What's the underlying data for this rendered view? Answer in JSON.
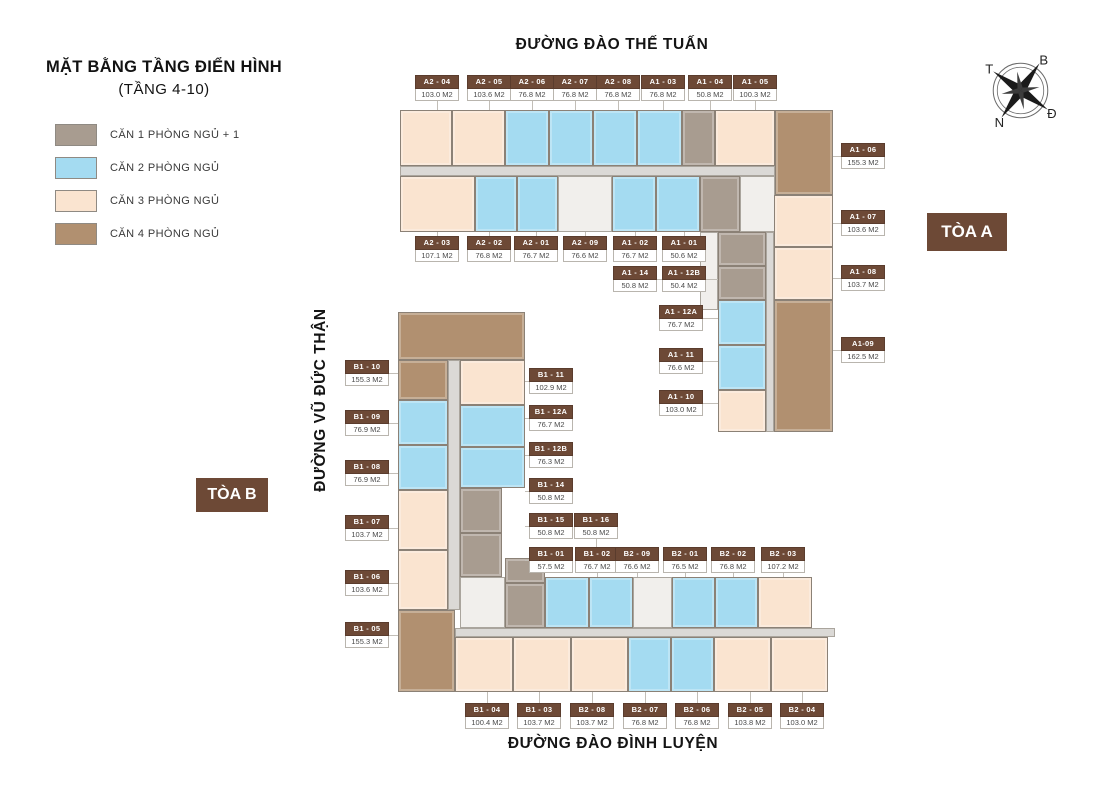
{
  "title": {
    "line1": "MẶT BẰNG TẦNG ĐIỂN HÌNH",
    "line2": "(TẦNG 4-10)"
  },
  "legend": [
    {
      "label": "CĂN 1 PHÒNG NGỦ + 1",
      "color": "#a89c90"
    },
    {
      "label": "CĂN 2 PHÒNG NGỦ",
      "color": "#a4dbf1"
    },
    {
      "label": "CĂN 3 PHÒNG NGỦ",
      "color": "#fae4d0"
    },
    {
      "label": "CĂN 4 PHÒNG NGỦ",
      "color": "#b19070"
    }
  ],
  "streets": {
    "top": "ĐƯỜNG ĐÀO THẾ TUẤN",
    "left": "ĐƯỜNG VŨ ĐỨC THẬN",
    "bottom": "ĐƯỜNG ĐÀO ĐÌNH LUYỆN"
  },
  "towers": {
    "a": "TÒA A",
    "b": "TÒA B"
  },
  "compass": {
    "north": "B",
    "east": "Đ",
    "south": "N",
    "west": "T"
  },
  "colors": {
    "t1": "#a89c90",
    "t2": "#a4dbf1",
    "t3": "#fae4d0",
    "t4": "#b19070",
    "core": "#f1efec",
    "corr": "#dbd9d6",
    "label_bg": "#6d4936",
    "tag_bg": "#6d4936"
  },
  "unit_labels": [
    {
      "code": "A2 - 04",
      "area": "103.0 M2",
      "x": 415,
      "y": 75,
      "dir": "d",
      "len": 9
    },
    {
      "code": "A2 - 05",
      "area": "103.6 M2",
      "x": 467,
      "y": 75,
      "dir": "d",
      "len": 9
    },
    {
      "code": "A2 - 06",
      "area": "76.8 M2",
      "x": 510,
      "y": 75,
      "dir": "d",
      "len": 9
    },
    {
      "code": "A2 - 07",
      "area": "76.8 M2",
      "x": 553,
      "y": 75,
      "dir": "d",
      "len": 9
    },
    {
      "code": "A2 - 08",
      "area": "76.8 M2",
      "x": 596,
      "y": 75,
      "dir": "d",
      "len": 9
    },
    {
      "code": "A1 - 03",
      "area": "76.8 M2",
      "x": 641,
      "y": 75,
      "dir": "d",
      "len": 9
    },
    {
      "code": "A1 - 04",
      "area": "50.8 M2",
      "x": 688,
      "y": 75,
      "dir": "d",
      "len": 9
    },
    {
      "code": "A1 - 05",
      "area": "100.3 M2",
      "x": 733,
      "y": 75,
      "dir": "d",
      "len": 9
    },
    {
      "code": "A2 - 03",
      "area": "107.1 M2",
      "x": 415,
      "y": 236,
      "dir": "u",
      "len": 4
    },
    {
      "code": "A2 - 02",
      "area": "76.8 M2",
      "x": 467,
      "y": 236,
      "dir": "u",
      "len": 4
    },
    {
      "code": "A2 - 01",
      "area": "76.7 M2",
      "x": 514,
      "y": 236,
      "dir": "u",
      "len": 4
    },
    {
      "code": "A2 - 09",
      "area": "76.6 M2",
      "x": 563,
      "y": 236,
      "dir": "u",
      "len": 4
    },
    {
      "code": "A1 - 02",
      "area": "76.7 M2",
      "x": 613,
      "y": 236,
      "dir": "u",
      "len": 4
    },
    {
      "code": "A1 - 01",
      "area": "50.6 M2",
      "x": 662,
      "y": 236,
      "dir": "u",
      "len": 4
    },
    {
      "code": "A1 - 14",
      "area": "50.8 M2",
      "x": 613,
      "y": 266,
      "dir": "r",
      "len": 61
    },
    {
      "code": "A1 - 12B",
      "area": "50.4 M2",
      "x": 662,
      "y": 266,
      "dir": "r",
      "len": 12
    },
    {
      "code": "A1 - 12A",
      "area": "76.7 M2",
      "x": 659,
      "y": 305,
      "dir": "r",
      "len": 15
    },
    {
      "code": "A1 - 11",
      "area": "76.6 M2",
      "x": 659,
      "y": 348,
      "dir": "r",
      "len": 15
    },
    {
      "code": "A1 - 10",
      "area": "103.0 M2",
      "x": 659,
      "y": 390,
      "dir": "r",
      "len": 15
    },
    {
      "code": "A1 - 06",
      "area": "155.3 M2",
      "x": 841,
      "y": 143,
      "dir": "l",
      "len": 8
    },
    {
      "code": "A1 - 07",
      "area": "103.6 M2",
      "x": 841,
      "y": 210,
      "dir": "l",
      "len": 8
    },
    {
      "code": "A1 - 08",
      "area": "103.7 M2",
      "x": 841,
      "y": 265,
      "dir": "l",
      "len": 8
    },
    {
      "code": "A1-09",
      "area": "162.5 M2",
      "x": 841,
      "y": 337,
      "dir": "l",
      "len": 8
    },
    {
      "code": "B1 - 10",
      "area": "155.3 M2",
      "x": 345,
      "y": 360,
      "dir": "r",
      "len": 9
    },
    {
      "code": "B1 - 09",
      "area": "76.9 M2",
      "x": 345,
      "y": 410,
      "dir": "r",
      "len": 9
    },
    {
      "code": "B1 - 08",
      "area": "76.9 M2",
      "x": 345,
      "y": 460,
      "dir": "r",
      "len": 9
    },
    {
      "code": "B1 - 07",
      "area": "103.7 M2",
      "x": 345,
      "y": 515,
      "dir": "r",
      "len": 9
    },
    {
      "code": "B1 - 06",
      "area": "103.6 M2",
      "x": 345,
      "y": 570,
      "dir": "r",
      "len": 9
    },
    {
      "code": "B1 - 05",
      "area": "155.3 M2",
      "x": 345,
      "y": 622,
      "dir": "r",
      "len": 9
    },
    {
      "code": "B1 - 11",
      "area": "102.9 M2",
      "x": 529,
      "y": 368,
      "dir": "l",
      "len": 4
    },
    {
      "code": "B1 - 12A",
      "area": "76.7 M2",
      "x": 529,
      "y": 405,
      "dir": "l",
      "len": 4
    },
    {
      "code": "B1 - 12B",
      "area": "76.3 M2",
      "x": 529,
      "y": 442,
      "dir": "l",
      "len": 4
    },
    {
      "code": "B1 - 14",
      "area": "50.8 M2",
      "x": 529,
      "y": 478,
      "dir": "l",
      "len": 4
    },
    {
      "code": "B1 - 15",
      "area": "50.8 M2",
      "x": 529,
      "y": 513,
      "dir": "l",
      "len": 4
    },
    {
      "code": "B1 - 01",
      "area": "57.5 M2",
      "x": 529,
      "y": 547,
      "dir": "l",
      "len": 4
    },
    {
      "code": "B1 - 16",
      "area": "50.8 M2",
      "x": 574,
      "y": 513,
      "dir": "d",
      "len": 19
    },
    {
      "code": "B1 - 02",
      "area": "76.7 M2",
      "x": 575,
      "y": 547,
      "dir": "d",
      "len": 4
    },
    {
      "code": "B2 - 09",
      "area": "76.6 M2",
      "x": 615,
      "y": 547,
      "dir": "d",
      "len": 4
    },
    {
      "code": "B2 - 01",
      "area": "76.5 M2",
      "x": 663,
      "y": 547,
      "dir": "d",
      "len": 4
    },
    {
      "code": "B2 - 02",
      "area": "76.8 M2",
      "x": 711,
      "y": 547,
      "dir": "d",
      "len": 4
    },
    {
      "code": "B2 - 03",
      "area": "107.2 M2",
      "x": 761,
      "y": 547,
      "dir": "d",
      "len": 4
    },
    {
      "code": "B1 - 04",
      "area": "100.4 M2",
      "x": 465,
      "y": 703,
      "dir": "u",
      "len": 11
    },
    {
      "code": "B1 - 03",
      "area": "103.7 M2",
      "x": 517,
      "y": 703,
      "dir": "u",
      "len": 11
    },
    {
      "code": "B2 - 08",
      "area": "103.7 M2",
      "x": 570,
      "y": 703,
      "dir": "u",
      "len": 11
    },
    {
      "code": "B2 - 07",
      "area": "76.8 M2",
      "x": 623,
      "y": 703,
      "dir": "u",
      "len": 11
    },
    {
      "code": "B2 - 06",
      "area": "76.8 M2",
      "x": 675,
      "y": 703,
      "dir": "u",
      "len": 11
    },
    {
      "code": "B2 - 05",
      "area": "103.8 M2",
      "x": 728,
      "y": 703,
      "dir": "u",
      "len": 11
    },
    {
      "code": "B2 - 04",
      "area": "103.0 M2",
      "x": 780,
      "y": 703,
      "dir": "u",
      "len": 11
    }
  ],
  "plan_blocks": [
    {
      "n": "unit-a2-04",
      "t": "t3",
      "x": 400,
      "y": 110,
      "w": 52,
      "h": 56
    },
    {
      "n": "unit-a2-05",
      "t": "t3",
      "x": 452,
      "y": 110,
      "w": 53,
      "h": 56
    },
    {
      "n": "unit-a2-06",
      "t": "t2",
      "x": 505,
      "y": 110,
      "w": 44,
      "h": 56
    },
    {
      "n": "unit-a2-07",
      "t": "t2",
      "x": 549,
      "y": 110,
      "w": 44,
      "h": 56
    },
    {
      "n": "unit-a2-08",
      "t": "t2",
      "x": 593,
      "y": 110,
      "w": 44,
      "h": 56
    },
    {
      "n": "unit-a1-03",
      "t": "t2",
      "x": 637,
      "y": 110,
      "w": 45,
      "h": 56
    },
    {
      "n": "unit-a1-04",
      "t": "t1",
      "x": 682,
      "y": 110,
      "w": 33,
      "h": 56
    },
    {
      "n": "unit-a1-05",
      "t": "t3",
      "x": 715,
      "y": 110,
      "w": 60,
      "h": 56
    },
    {
      "n": "unit-a1-06",
      "t": "t4",
      "x": 775,
      "y": 110,
      "w": 58,
      "h": 85
    },
    {
      "n": "corridor-tower-a",
      "t": "corr",
      "x": 400,
      "y": 166,
      "w": 375,
      "h": 10
    },
    {
      "n": "unit-a2-03",
      "t": "t3",
      "x": 400,
      "y": 176,
      "w": 75,
      "h": 56
    },
    {
      "n": "unit-a2-02",
      "t": "t2",
      "x": 475,
      "y": 176,
      "w": 42,
      "h": 56
    },
    {
      "n": "unit-a2-01",
      "t": "t2",
      "x": 517,
      "y": 176,
      "w": 41,
      "h": 56
    },
    {
      "n": "core-tower-a-1",
      "t": "core",
      "x": 558,
      "y": 176,
      "w": 54,
      "h": 56
    },
    {
      "n": "unit-a2-09",
      "t": "t2",
      "x": 612,
      "y": 176,
      "w": 44,
      "h": 56
    },
    {
      "n": "unit-a1-02",
      "t": "t2",
      "x": 656,
      "y": 176,
      "w": 44,
      "h": 56
    },
    {
      "n": "unit-a1-01",
      "t": "t1",
      "x": 700,
      "y": 176,
      "w": 40,
      "h": 56
    },
    {
      "n": "core-tower-a-2",
      "t": "core",
      "x": 740,
      "y": 176,
      "w": 35,
      "h": 56
    },
    {
      "n": "core-tower-a-3",
      "t": "core",
      "x": 700,
      "y": 232,
      "w": 18,
      "h": 78
    },
    {
      "n": "unit-a1-14",
      "t": "t1",
      "x": 718,
      "y": 232,
      "w": 48,
      "h": 34
    },
    {
      "n": "unit-a1-12b",
      "t": "t1",
      "x": 718,
      "y": 266,
      "w": 48,
      "h": 34
    },
    {
      "n": "unit-a1-12a",
      "t": "t2",
      "x": 718,
      "y": 300,
      "w": 48,
      "h": 45
    },
    {
      "n": "unit-a1-11",
      "t": "t2",
      "x": 718,
      "y": 345,
      "w": 48,
      "h": 45
    },
    {
      "n": "unit-a1-10",
      "t": "t3",
      "x": 718,
      "y": 390,
      "w": 48,
      "h": 42
    },
    {
      "n": "corridor-wing-a",
      "t": "corr",
      "x": 766,
      "y": 232,
      "w": 8,
      "h": 200
    },
    {
      "n": "unit-a1-07",
      "t": "t3",
      "x": 774,
      "y": 195,
      "w": 59,
      "h": 52
    },
    {
      "n": "unit-a1-08",
      "t": "t3",
      "x": 774,
      "y": 247,
      "w": 59,
      "h": 53
    },
    {
      "n": "unit-a1-09",
      "t": "t4",
      "x": 774,
      "y": 300,
      "w": 59,
      "h": 132
    },
    {
      "n": "unit-b1-10",
      "t": "t4",
      "x": 398,
      "y": 312,
      "w": 127,
      "h": 48
    },
    {
      "n": "unit-b1-10-lower",
      "t": "t4",
      "x": 398,
      "y": 360,
      "w": 50,
      "h": 40
    },
    {
      "n": "unit-b1-11",
      "t": "t3",
      "x": 460,
      "y": 360,
      "w": 65,
      "h": 45
    },
    {
      "n": "unit-b1-09",
      "t": "t2",
      "x": 398,
      "y": 400,
      "w": 50,
      "h": 45
    },
    {
      "n": "unit-b1-08",
      "t": "t2",
      "x": 398,
      "y": 445,
      "w": 50,
      "h": 45
    },
    {
      "n": "unit-b1-12a",
      "t": "t2",
      "x": 460,
      "y": 405,
      "w": 65,
      "h": 42
    },
    {
      "n": "unit-b1-12b",
      "t": "t2",
      "x": 460,
      "y": 447,
      "w": 65,
      "h": 41
    },
    {
      "n": "unit-b1-07",
      "t": "t3",
      "x": 398,
      "y": 490,
      "w": 50,
      "h": 60
    },
    {
      "n": "unit-b1-06",
      "t": "t3",
      "x": 398,
      "y": 550,
      "w": 50,
      "h": 60
    },
    {
      "n": "unit-b1-14",
      "t": "t1",
      "x": 460,
      "y": 488,
      "w": 42,
      "h": 45
    },
    {
      "n": "unit-b1-15",
      "t": "t1",
      "x": 460,
      "y": 533,
      "w": 42,
      "h": 44
    },
    {
      "n": "unit-b1-05",
      "t": "t4",
      "x": 398,
      "y": 610,
      "w": 57,
      "h": 82
    },
    {
      "n": "corridor-tower-b-vertical",
      "t": "corr",
      "x": 448,
      "y": 360,
      "w": 12,
      "h": 250
    },
    {
      "n": "core-tower-b-1",
      "t": "core",
      "x": 460,
      "y": 577,
      "w": 45,
      "h": 51
    },
    {
      "n": "unit-b1-16",
      "t": "t1",
      "x": 505,
      "y": 558,
      "w": 40,
      "h": 25
    },
    {
      "n": "unit-b1-01",
      "t": "t1",
      "x": 505,
      "y": 583,
      "w": 40,
      "h": 45
    },
    {
      "n": "unit-b1-02",
      "t": "t2",
      "x": 545,
      "y": 577,
      "w": 44,
      "h": 51
    },
    {
      "n": "unit-b2-09",
      "t": "t2",
      "x": 589,
      "y": 577,
      "w": 44,
      "h": 51
    },
    {
      "n": "core-tower-b-2",
      "t": "core",
      "x": 633,
      "y": 577,
      "w": 39,
      "h": 51
    },
    {
      "n": "unit-b2-01",
      "t": "t2",
      "x": 672,
      "y": 577,
      "w": 43,
      "h": 51
    },
    {
      "n": "unit-b2-02",
      "t": "t2",
      "x": 715,
      "y": 577,
      "w": 43,
      "h": 51
    },
    {
      "n": "unit-b2-03",
      "t": "t3",
      "x": 758,
      "y": 577,
      "w": 54,
      "h": 51
    },
    {
      "n": "corridor-tower-b-horizontal",
      "t": "corr",
      "x": 455,
      "y": 628,
      "w": 380,
      "h": 9
    },
    {
      "n": "unit-b1-04",
      "t": "t3",
      "x": 455,
      "y": 637,
      "w": 58,
      "h": 55
    },
    {
      "n": "unit-b1-03",
      "t": "t3",
      "x": 513,
      "y": 637,
      "w": 58,
      "h": 55
    },
    {
      "n": "unit-b2-08",
      "t": "t3",
      "x": 571,
      "y": 637,
      "w": 57,
      "h": 55
    },
    {
      "n": "unit-b2-07",
      "t": "t2",
      "x": 628,
      "y": 637,
      "w": 43,
      "h": 55
    },
    {
      "n": "unit-b2-06",
      "t": "t2",
      "x": 671,
      "y": 637,
      "w": 43,
      "h": 55
    },
    {
      "n": "unit-b2-05",
      "t": "t3",
      "x": 714,
      "y": 637,
      "w": 57,
      "h": 55
    },
    {
      "n": "unit-b2-04",
      "t": "t3",
      "x": 771,
      "y": 637,
      "w": 57,
      "h": 55
    }
  ]
}
